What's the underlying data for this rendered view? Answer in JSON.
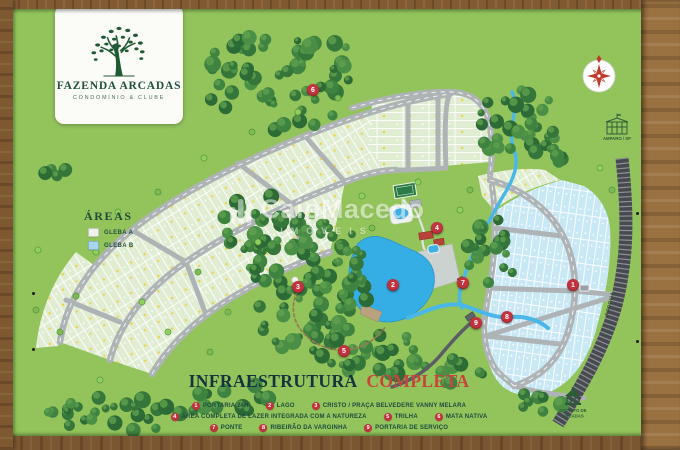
{
  "colors": {
    "board_green": "#93c45c",
    "lake_blue": "#35aee6",
    "marker_red": "#c2333e",
    "title_dark": "#14333d",
    "title_red": "#c7453c",
    "gleba_a_fill": "#e0edd2",
    "gleba_b_fill": "#c9e8f6",
    "road_gray": "#aeb3b6",
    "wood_frame": "#8a6134"
  },
  "logo": {
    "title": "FAZENDA ARCADAS",
    "subtitle": "CONDOMÍNIO & CLUBE"
  },
  "areas": {
    "title": "ÁREAS",
    "items": [
      {
        "label": "GLEBA A"
      },
      {
        "label": "GLEBA B"
      }
    ]
  },
  "watermark": {
    "name": "CaioMacedo",
    "line2": "IMÓVEIS"
  },
  "title": {
    "main": "INFRAESTRUTURA",
    "accent": "COMPLETA"
  },
  "legend": {
    "items": [
      {
        "num": "1",
        "label": "PORTARIA 24H"
      },
      {
        "num": "2",
        "label": "LAGO"
      },
      {
        "num": "3",
        "label": "CRISTO / PRAÇA BELVEDERE VANNY MELARA"
      },
      {
        "num": "4",
        "label": "ÁREA COMPLETA DE LAZER INTEGRADA COM A NATUREZA"
      },
      {
        "num": "5",
        "label": "TRILHA"
      },
      {
        "num": "6",
        "label": "MATA NATIVA"
      },
      {
        "num": "7",
        "label": "PONTE"
      },
      {
        "num": "8",
        "label": "RIBEIRÃO DA VARGINHA"
      },
      {
        "num": "9",
        "label": "PORTARIA DE SERVIÇO"
      }
    ]
  },
  "poi": {
    "city_label": "AMPARO / SP",
    "district_line1": "DISTRITO DE",
    "district_line2": "ARCADAS",
    "highway_label": "RODOVIA"
  }
}
